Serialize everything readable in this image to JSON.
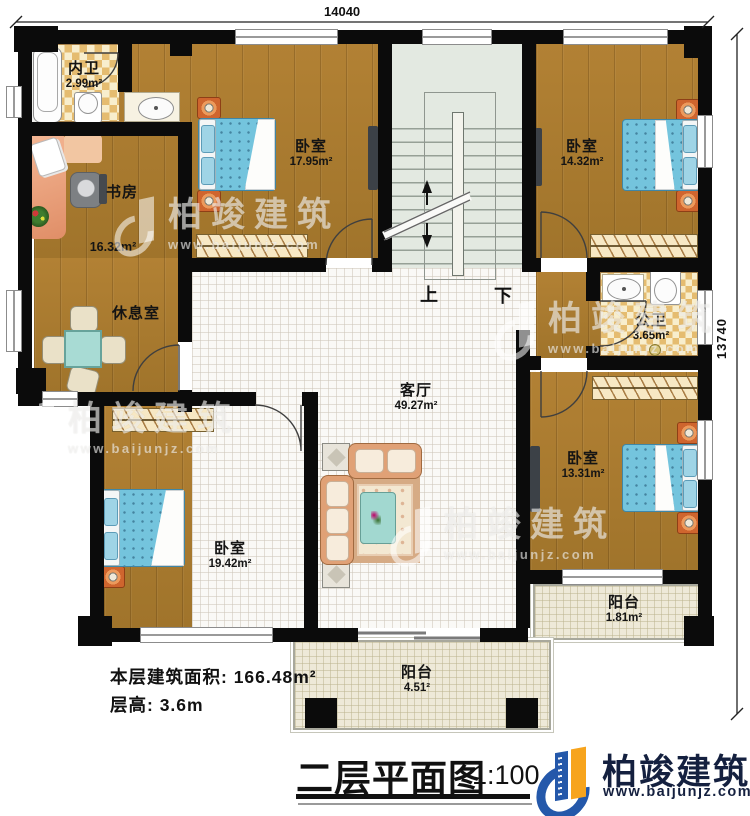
{
  "dims": {
    "top": "14040",
    "right": "13740"
  },
  "rooms": {
    "inner_bath": {
      "name": "内卫",
      "area": "2.99m²"
    },
    "study": {
      "name": "书房",
      "area": "16.32m²"
    },
    "lounge": {
      "name": "休息室"
    },
    "bedroom_top": {
      "name": "卧室",
      "area": "17.95m²"
    },
    "bedroom_tr": {
      "name": "卧室",
      "area": "14.32m²"
    },
    "public_bath": {
      "name": "公卫",
      "area": "3.65m²"
    },
    "bedroom_br": {
      "name": "卧室",
      "area": "13.31m²"
    },
    "living": {
      "name": "客厅",
      "area": "49.27m²"
    },
    "bedroom_bl": {
      "name": "卧室",
      "area": "19.42m²"
    },
    "balcony_right": {
      "name": "阳台",
      "area": "1.81m²"
    },
    "balcony_bottom": {
      "name": "阳台",
      "area": "4.51²"
    }
  },
  "stairs": {
    "up": "上",
    "down": "下"
  },
  "notes": {
    "floor_area": "本层建筑面积: 166.48m²",
    "floor_height": "层高: 3.6m"
  },
  "title": {
    "name": "二层平面图",
    "scale": "1:100"
  },
  "brand": {
    "name": "柏竣建筑",
    "url": "www.baijunjz.com"
  },
  "watermark": {
    "name": "柏竣建筑",
    "url": "www.baijunjz.com"
  },
  "colors": {
    "wall": "#0b0b0b",
    "wood": "#a97c31",
    "brand_blue": "#2458aa",
    "brand_orange": "#f7a41d",
    "brand_text": "#14203f"
  }
}
